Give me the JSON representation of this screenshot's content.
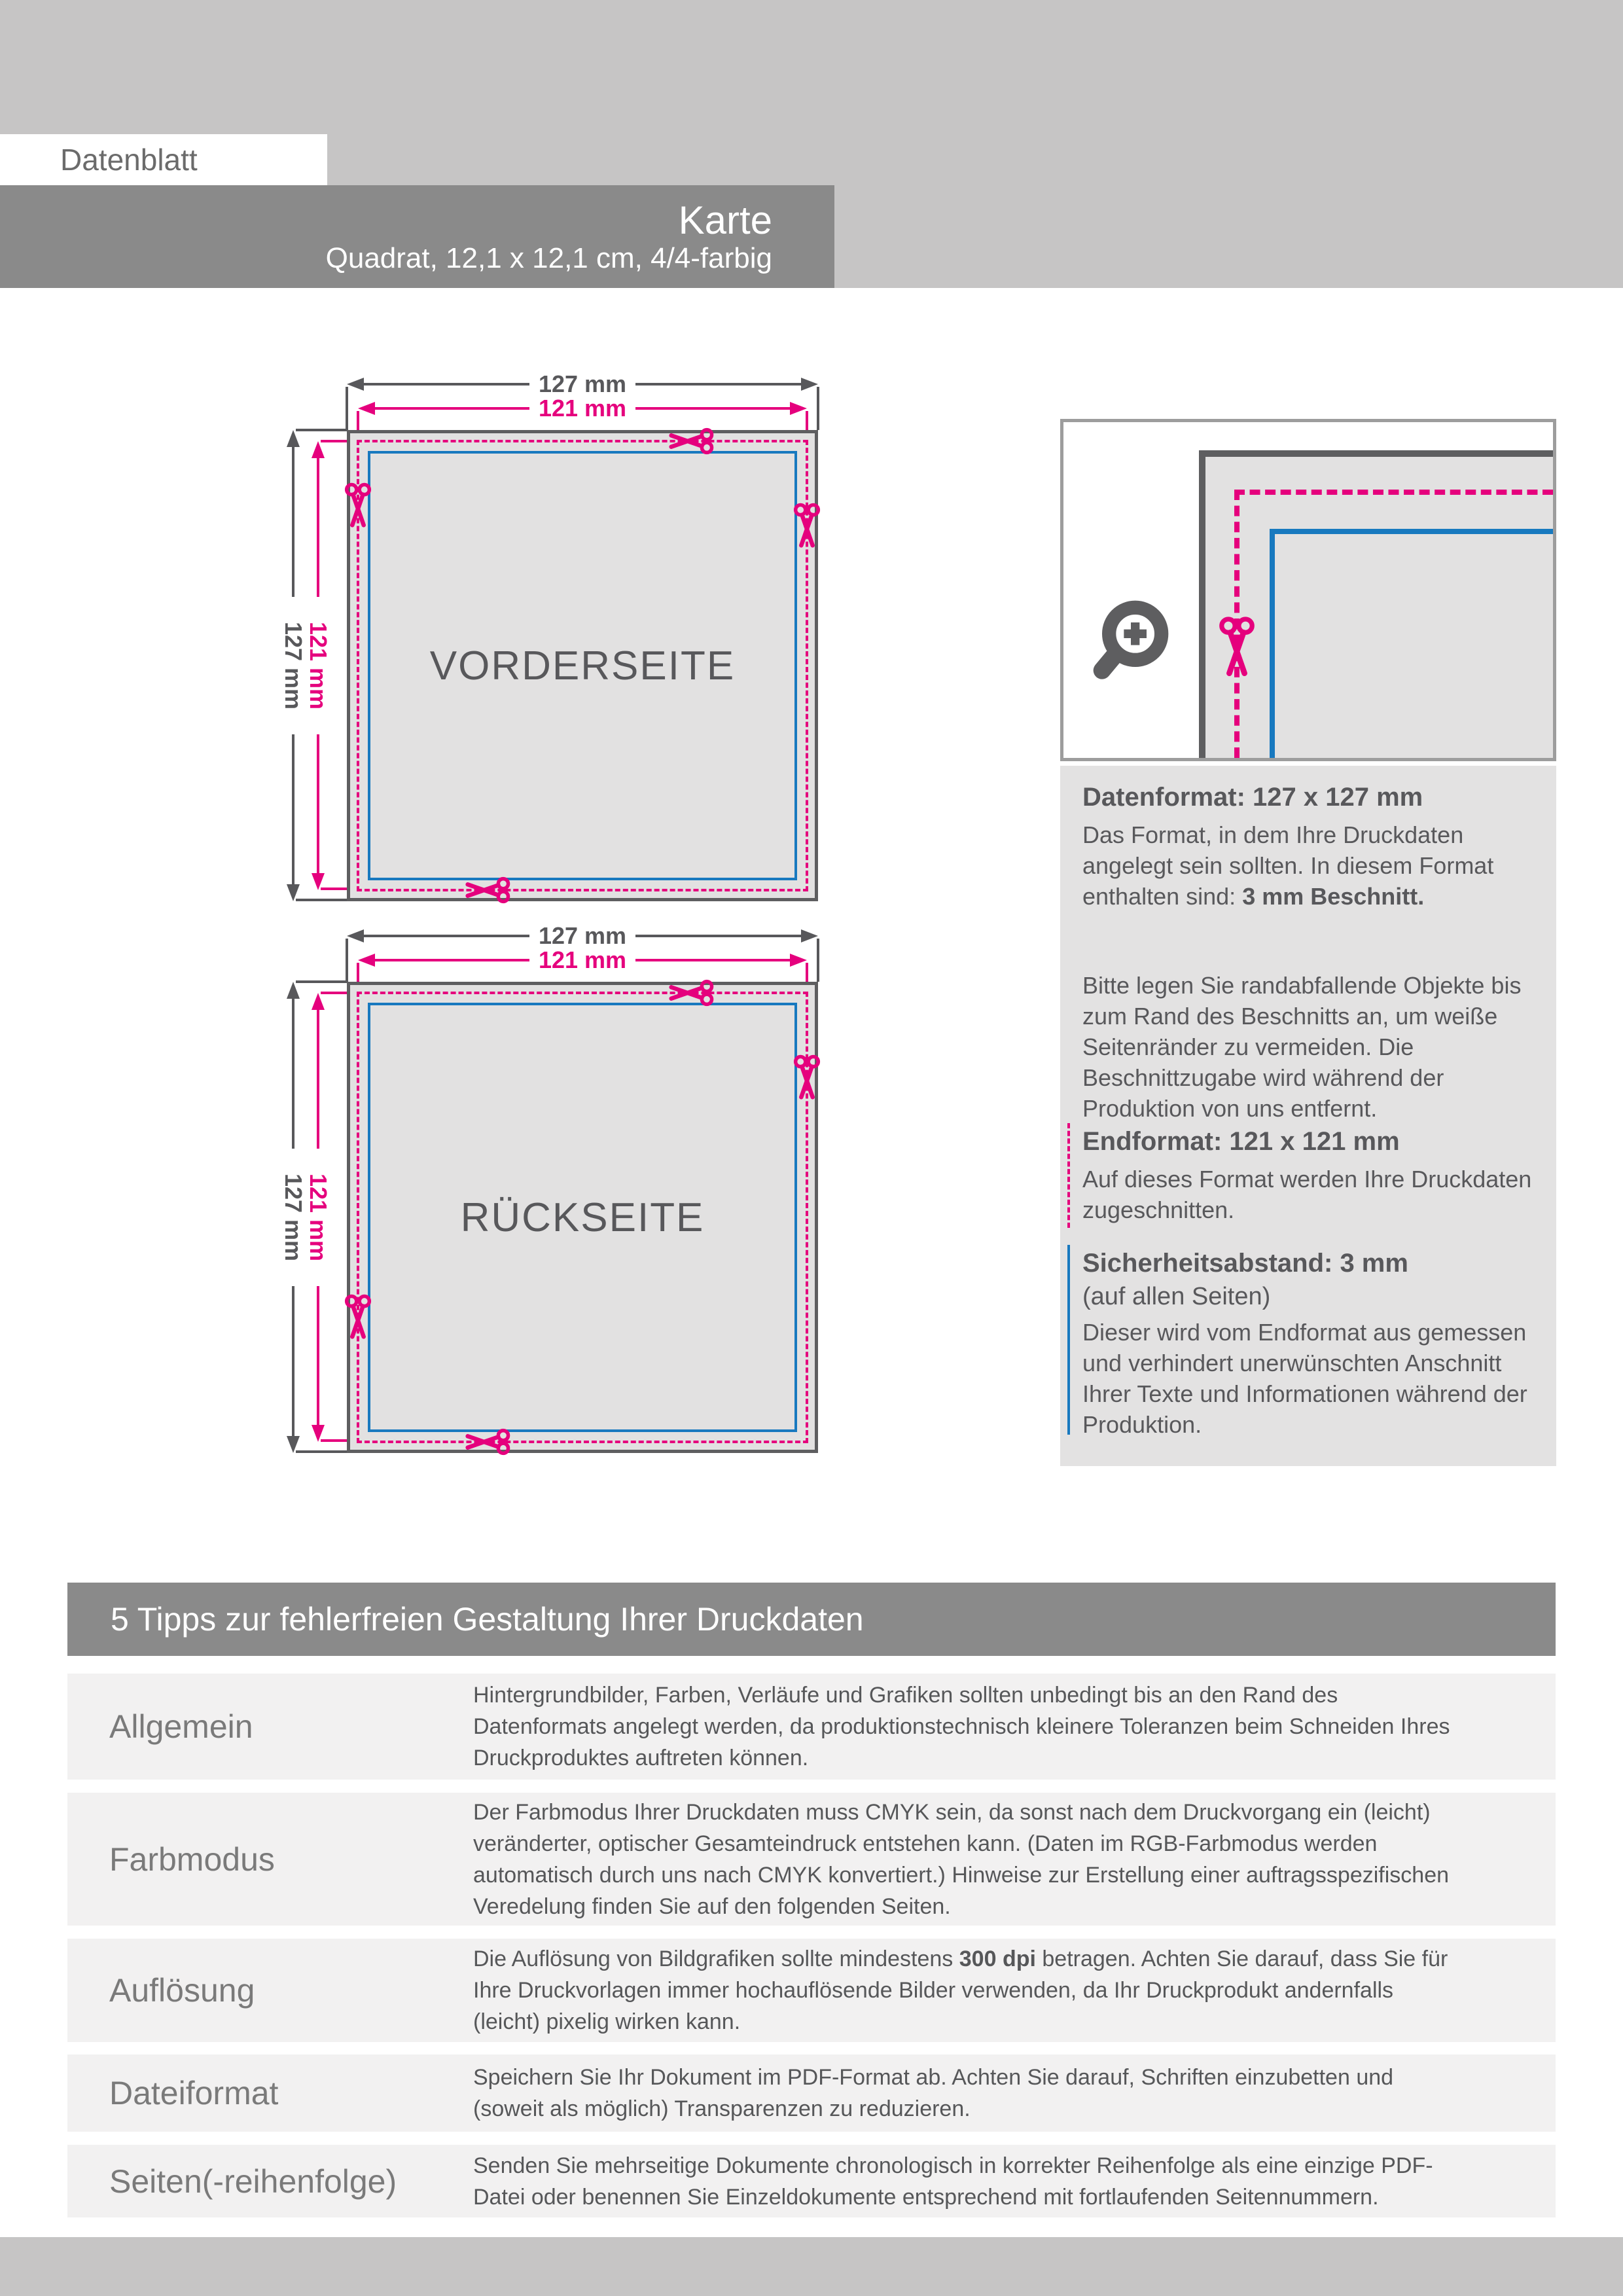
{
  "header": {
    "doc_label": "Datenblatt",
    "product_title": "Karte",
    "product_subtitle": "Quadrat, 12,1 x 12,1 cm, 4/4-farbig"
  },
  "diagram": {
    "front_label": "VORDERSEITE",
    "back_label": "RÜCKSEITE",
    "dim_outer": "127 mm",
    "dim_trim": "121 mm"
  },
  "icons": {
    "magnifier": "zoom-magnifier-icon",
    "scissors": "scissors-cut-icon"
  },
  "info_panel": {
    "datenformat": {
      "heading": "Datenformat: 127 x 127 mm",
      "p1_before": "Das Format, in dem Ihre Druckdaten angelegt sein sollten. In diesem Format enthalten sind: ",
      "p1_bold": "3 mm Beschnitt.",
      "p2": "Bitte legen Sie randabfallende Objekte bis zum Rand des Beschnitts an, um weiße Seitenränder zu vermeiden. Die Beschnittzugabe wird während der Produktion von uns entfernt."
    },
    "endformat": {
      "heading": "Endformat: 121 x 121 mm",
      "body": "Auf dieses Format werden Ihre Druckdaten zugeschnitten."
    },
    "sicherheitsabstand": {
      "heading": "Sicherheitsabstand: 3 mm",
      "subheading": "(auf allen Seiten)",
      "body": "Dieser wird vom Endformat aus gemessen und verhindert unerwünschten Anschnitt Ihrer Texte und Informationen während der Produktion."
    }
  },
  "tips": {
    "title": "5 Tipps zur fehlerfreien Gestaltung Ihrer Druckdaten",
    "rows": [
      {
        "label": "Allgemein",
        "before": "Hintergrundbilder, Farben, Verläufe und Grafiken sollten unbedingt bis an den Rand des Datenformats angelegt werden, da produktionstechnisch kleinere Toleranzen beim Schneiden Ihres Druckproduktes auftreten können.",
        "bold": "",
        "after": ""
      },
      {
        "label": "Farbmodus",
        "before": "Der Farbmodus Ihrer Druckdaten muss CMYK sein, da sonst nach dem Druckvorgang ein (leicht) veränderter, optischer Gesamteindruck entstehen kann. (Daten im RGB-Farbmodus werden automatisch durch uns nach CMYK konvertiert.) Hinweise zur Erstellung einer auftragsspezifischen Veredelung finden Sie auf den folgenden Seiten.",
        "bold": "",
        "after": ""
      },
      {
        "label": "Auflösung",
        "before": "Die Auflösung von Bildgrafiken sollte mindestens ",
        "bold": "300 dpi",
        "after": " betragen. Achten Sie darauf, dass Sie für Ihre Druckvorlagen immer hochauflösende Bilder verwenden, da Ihr Druckprodukt andernfalls (leicht) pixelig wirken kann."
      },
      {
        "label": "Dateiformat",
        "before": "Speichern Sie Ihr Dokument im PDF-Format ab. Achten Sie darauf, Schriften einzubetten und (soweit als möglich) Transparenzen zu reduzieren.",
        "bold": "",
        "after": ""
      },
      {
        "label": "Seiten(-reihenfolge)",
        "before": "Senden Sie mehrseitige Dokumente chronologisch in korrekter Reihenfolge als eine einzige PDF-Datei oder benennen Sie Einzeldokumente entsprechend mit fortlaufenden Seitennummern.",
        "bold": "",
        "after": ""
      }
    ]
  },
  "colors": {
    "magenta_accent": "#e5007d",
    "blue_accent": "#1879bf",
    "dim_dark_gray": "#58585b",
    "bar_gray": "#8a8a8a",
    "page_gray": "#c6c5c5",
    "card_fill_gray": "#e2e1e1",
    "panel_bg_gray": "#e3e2e2",
    "row_bg_gray": "#f2f1f1",
    "box_border_gray": "#9d9d9d"
  }
}
